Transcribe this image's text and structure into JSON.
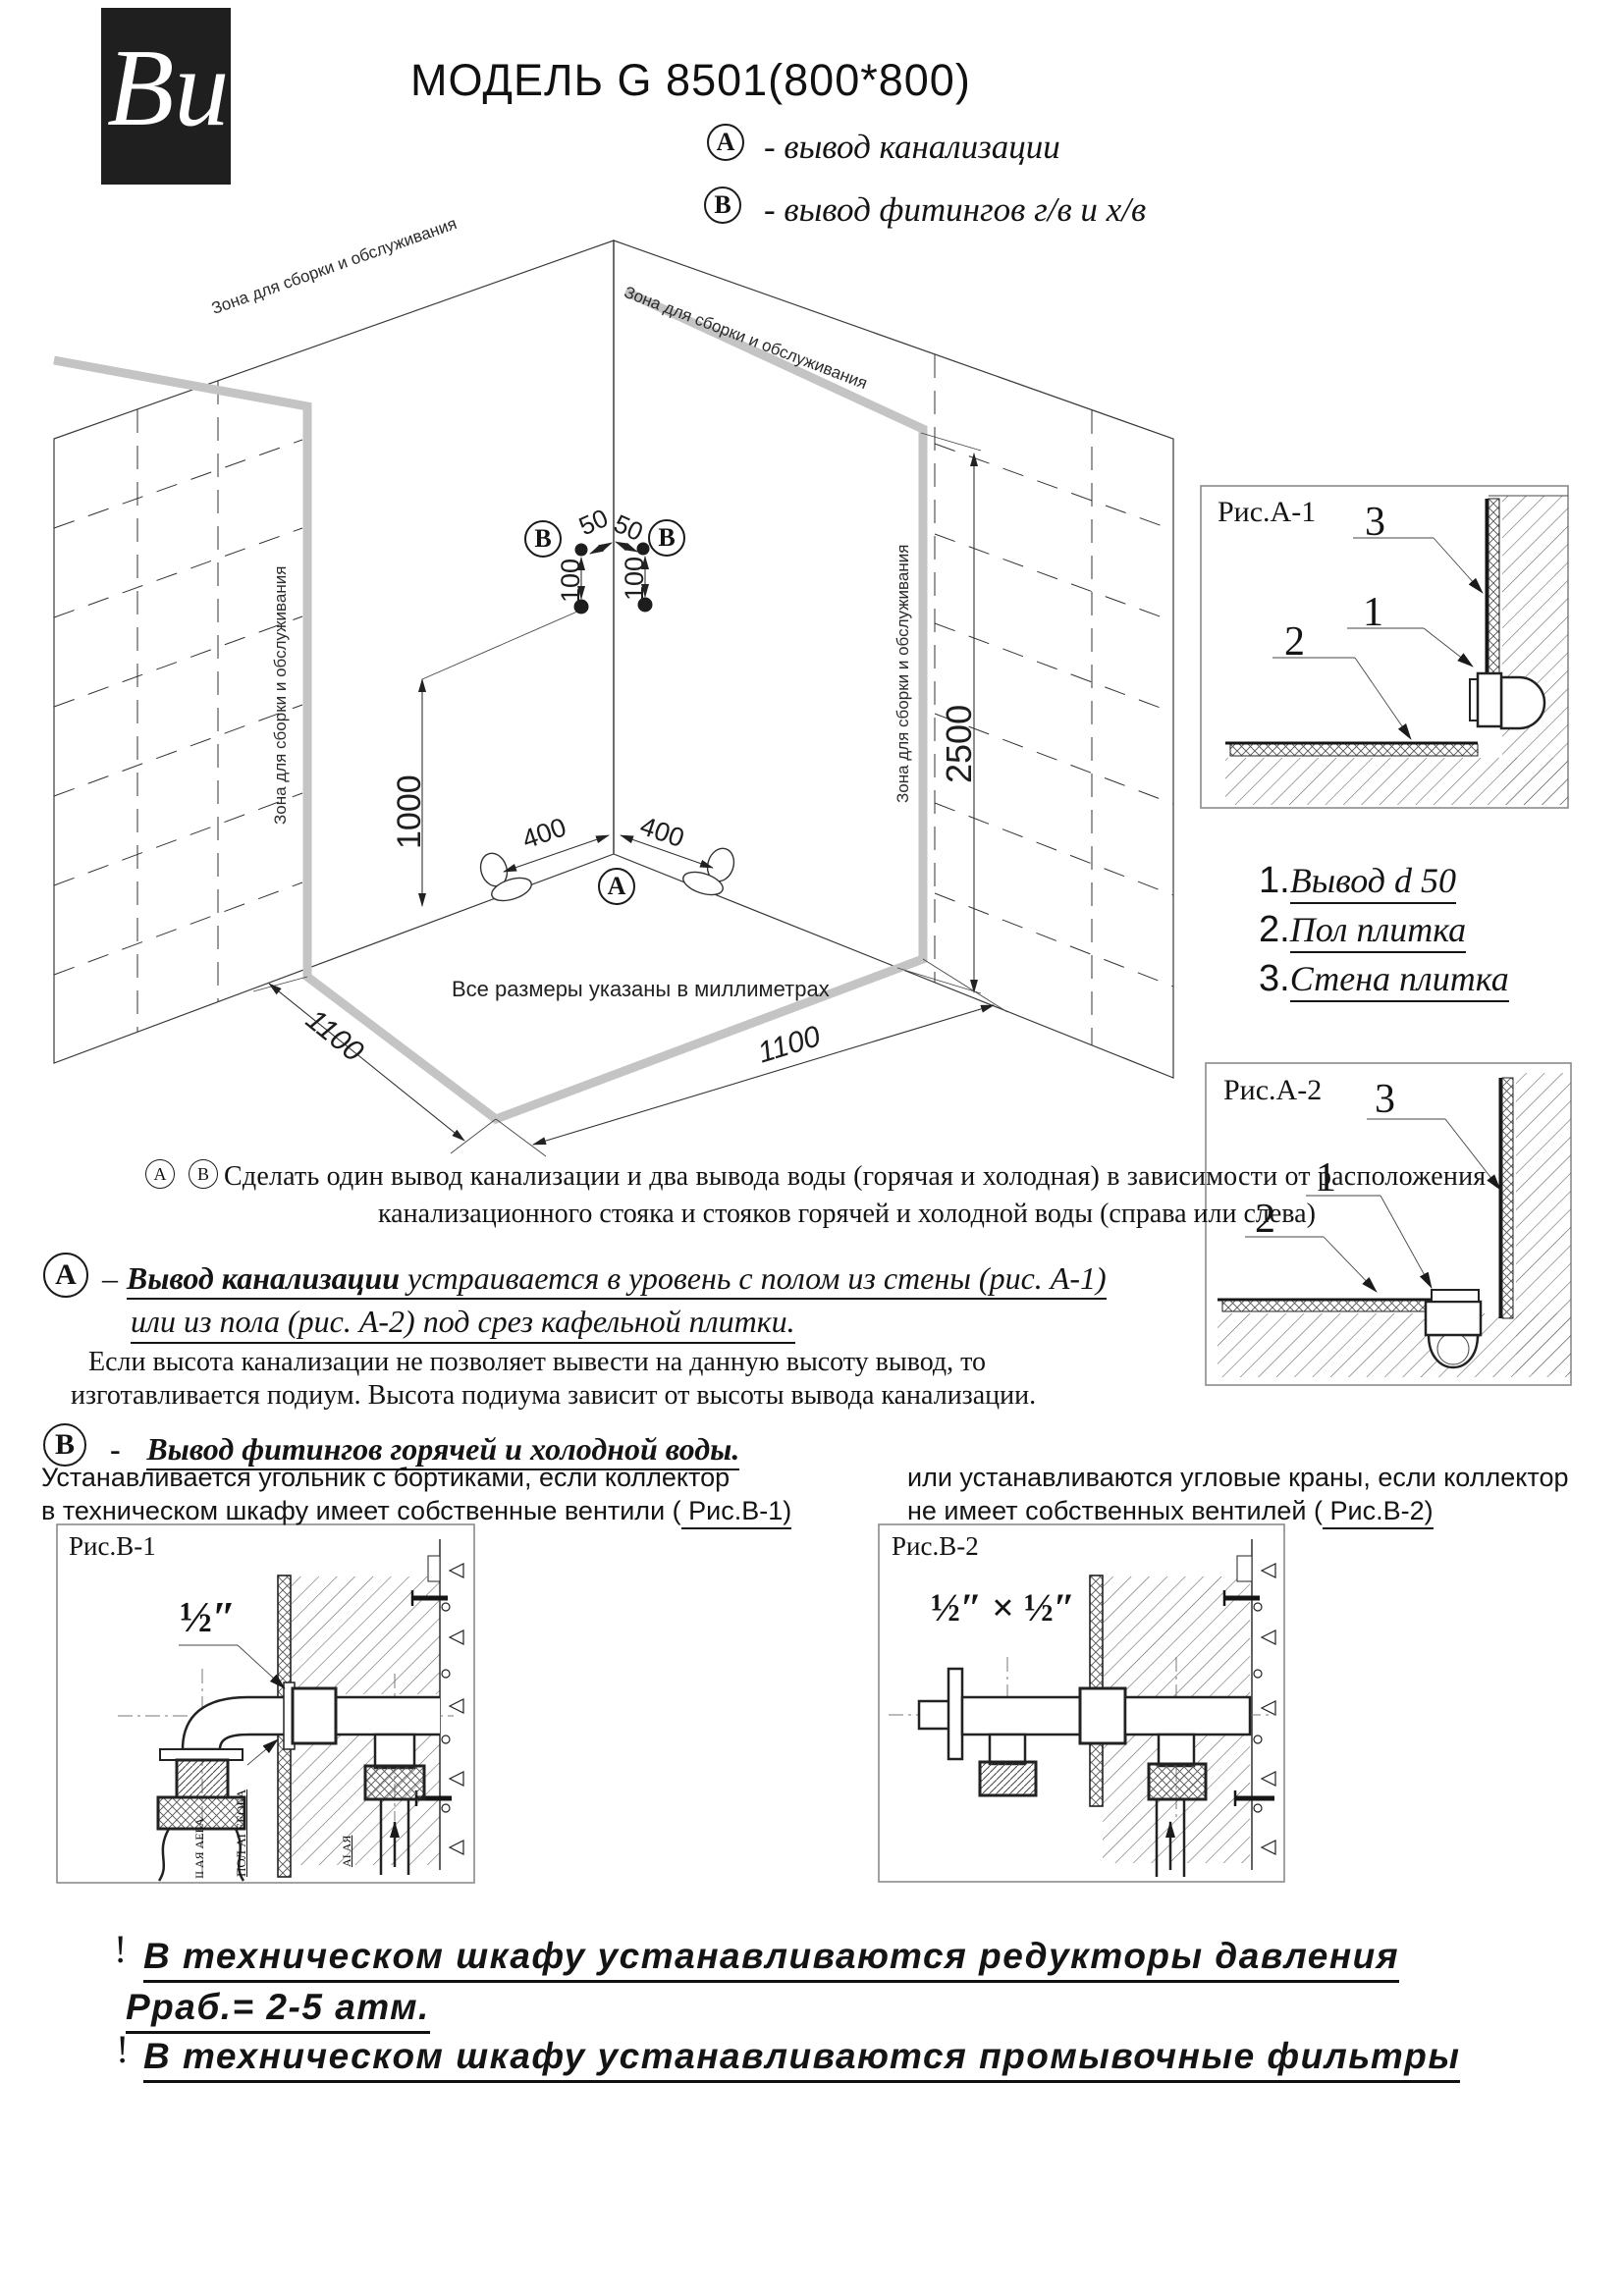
{
  "title": "МОДЕЛЬ G 8501(800*800)",
  "logo_text": "Ви",
  "legend": {
    "a_marker": "A",
    "a_text": "-  вывод канализации",
    "b_marker": "B",
    "b_text": "-  вывод фитингов г/в и х/в"
  },
  "diagram": {
    "zone_top_left": "Зона для сборки и обслуживания",
    "zone_top_right": "Зона для сборки и обслуживания",
    "zone_left": "Зона для сборки и обслуживания",
    "zone_right": "Зона для сборки и обслуживания",
    "note": "Все размеры указаны в миллиметрах",
    "marker_a": "A",
    "marker_b_left": "B",
    "marker_b_right": "B",
    "dim_50_left": "50",
    "dim_50_right": "50",
    "dim_100_left": "100",
    "dim_100_right": "100",
    "dim_400_left": "400",
    "dim_400_right": "400",
    "dim_1000": "1000",
    "dim_2500": "2500",
    "dim_1100_left": "1100",
    "dim_1100_right": "1100"
  },
  "fig_a1": {
    "title": "Рис.А-1",
    "label_1": "1",
    "label_2": "2",
    "label_3": "3"
  },
  "fig_a2": {
    "title": "Рис.А-2",
    "label_1": "1",
    "label_2": "2",
    "label_3": "3"
  },
  "parts_list": [
    {
      "num": "1.",
      "text": "Вывод d 50"
    },
    {
      "num": "2.",
      "text": "Пол плитка"
    },
    {
      "num": "3.",
      "text": "Стена плитка"
    }
  ],
  "note_ab": {
    "marker_a": "А",
    "marker_b": "В",
    "line1": "Сделать один вывод канализации и два вывода воды (горячая и холодная) в зависимости  от расположения",
    "line2": "канализационного стояка и стояков горячей и холодной воды (справа или слева)"
  },
  "section_a": {
    "marker": "А",
    "prefix": "–",
    "term": "Вывод канализации",
    "line1_rest": " устраивается в уровень с полом из стены (рис. А-1)",
    "line2": "или из пола (рис. А-2) под срез кафельной плитки.",
    "line3": "Если высота канализации не позволяет вывести на данную высоту вывод, то",
    "line4": "изготавливается подиум. Высота подиума зависит от высоты вывода канализации."
  },
  "section_b": {
    "marker": "В",
    "prefix": "-",
    "heading": "Вывод фитингов горячей и холодной воды.",
    "left_line1": "Устанавливается угольник с бортиками,  если коллектор",
    "left_line2": "в техническом шкафу имеет собственные вентили (",
    "left_link": " Рис.В-1)",
    "right_line1": "или  устанавливаются угловые краны, если коллектор",
    "right_line2": "не имеет собственных вентилей (",
    "right_link": " Рис.В-2)"
  },
  "fig_b1": {
    "title": "Рис.В-1",
    "size_label": "½″",
    "rot_label_wall": "ПОЛ АІ ЕЕОБА",
    "rot_label_hose": "ІІ АЯ АЕБА",
    "rot_label_tee": "АІ АЯ"
  },
  "fig_b2": {
    "title": "Рис.В-2",
    "size_label": "½″ × ½″"
  },
  "warnings": {
    "mark1": "!",
    "line1": "В техническом шкафу устанавливаются редукторы давления",
    "line2": "Рраб.= 2-5 атм.",
    "mark2": "!",
    "line3": "В техническом шкафу устанавливаются промывочные фильтры"
  }
}
